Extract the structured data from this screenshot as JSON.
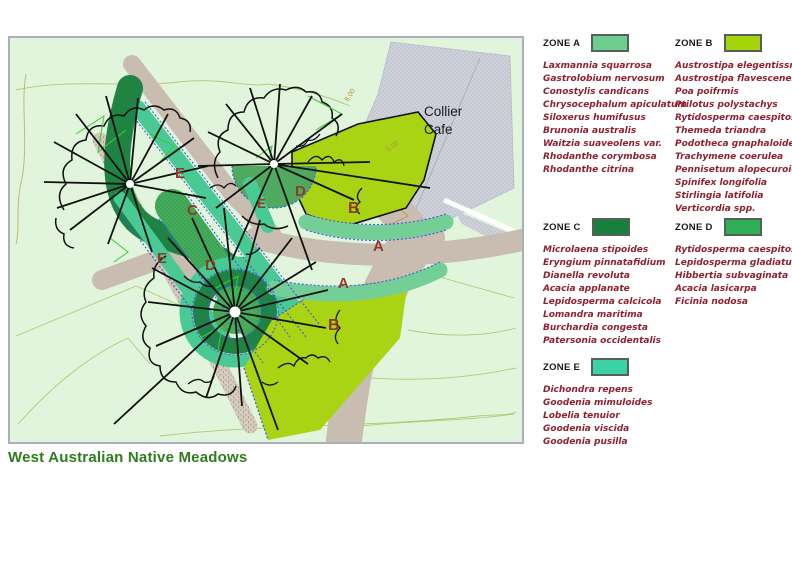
{
  "title": "West Australian Native Meadows",
  "map": {
    "cafe_line1": "Collier",
    "cafe_line2": "Cafe",
    "dims": {
      "d1": "8.00",
      "d2": "5.00"
    },
    "labels": [
      {
        "t": "E"
      },
      {
        "t": "C"
      },
      {
        "t": "E"
      },
      {
        "t": "D"
      },
      {
        "t": "E"
      },
      {
        "t": "D"
      },
      {
        "t": "B"
      },
      {
        "t": "A"
      },
      {
        "t": "A"
      },
      {
        "t": "B"
      }
    ]
  },
  "legend": {
    "zones": [
      {
        "name": "ZONE A",
        "color": "#6fce8f",
        "species": [
          "Laxmannia squarrosa",
          "Gastrolobium nervosum",
          "Conostylis candicans",
          "Chrysocephalum apiculatum",
          "Siloxerus humifusus",
          "Brunonia australis",
          "Waitzia suaveolens var.",
          "Rhodanthe corymbosa",
          "Rhodanthe citrina"
        ]
      },
      {
        "name": "ZONE B",
        "color": "#a6d40c",
        "species": [
          "Austrostipa elegentissm",
          "Austrostipa flavescenes",
          "Poa poifrmis",
          "Ptilotus polystachys",
          "Rytidosperma caespitosum",
          "Themeda triandra",
          "Podotheca gnaphaloides",
          "Trachymene coerulea",
          "Pennisetum alopecuroides",
          "Spinifex longifolia",
          "Stirlingia latifolia",
          "Verticordia spp."
        ]
      },
      {
        "name": "ZONE C",
        "color": "#17803c",
        "species": [
          "Microlaena stipoides",
          "Eryngium pinnatafidium",
          "Dianella revoluta",
          "Acacia applanate",
          "Lepidosperma calcicola",
          "Lomandra maritima",
          "Burchardia congesta",
          "Patersonia occidentalis"
        ]
      },
      {
        "name": "ZONE D",
        "color": "#2eaf55",
        "species": [
          "Rytidosperma caespitosum",
          "Lepidosperma gladiatum",
          "Hibbertia subvaginata",
          "Acacia lasicarpa",
          "Ficinia nodosa"
        ]
      },
      {
        "name": "ZONE E",
        "color": "#3bd3a5",
        "species": [
          "Dichondra repens",
          "Goodenia mimuloides",
          "Lobelia tenuior",
          "Goodenia viscida",
          "Goodenia pusilla"
        ]
      }
    ]
  }
}
